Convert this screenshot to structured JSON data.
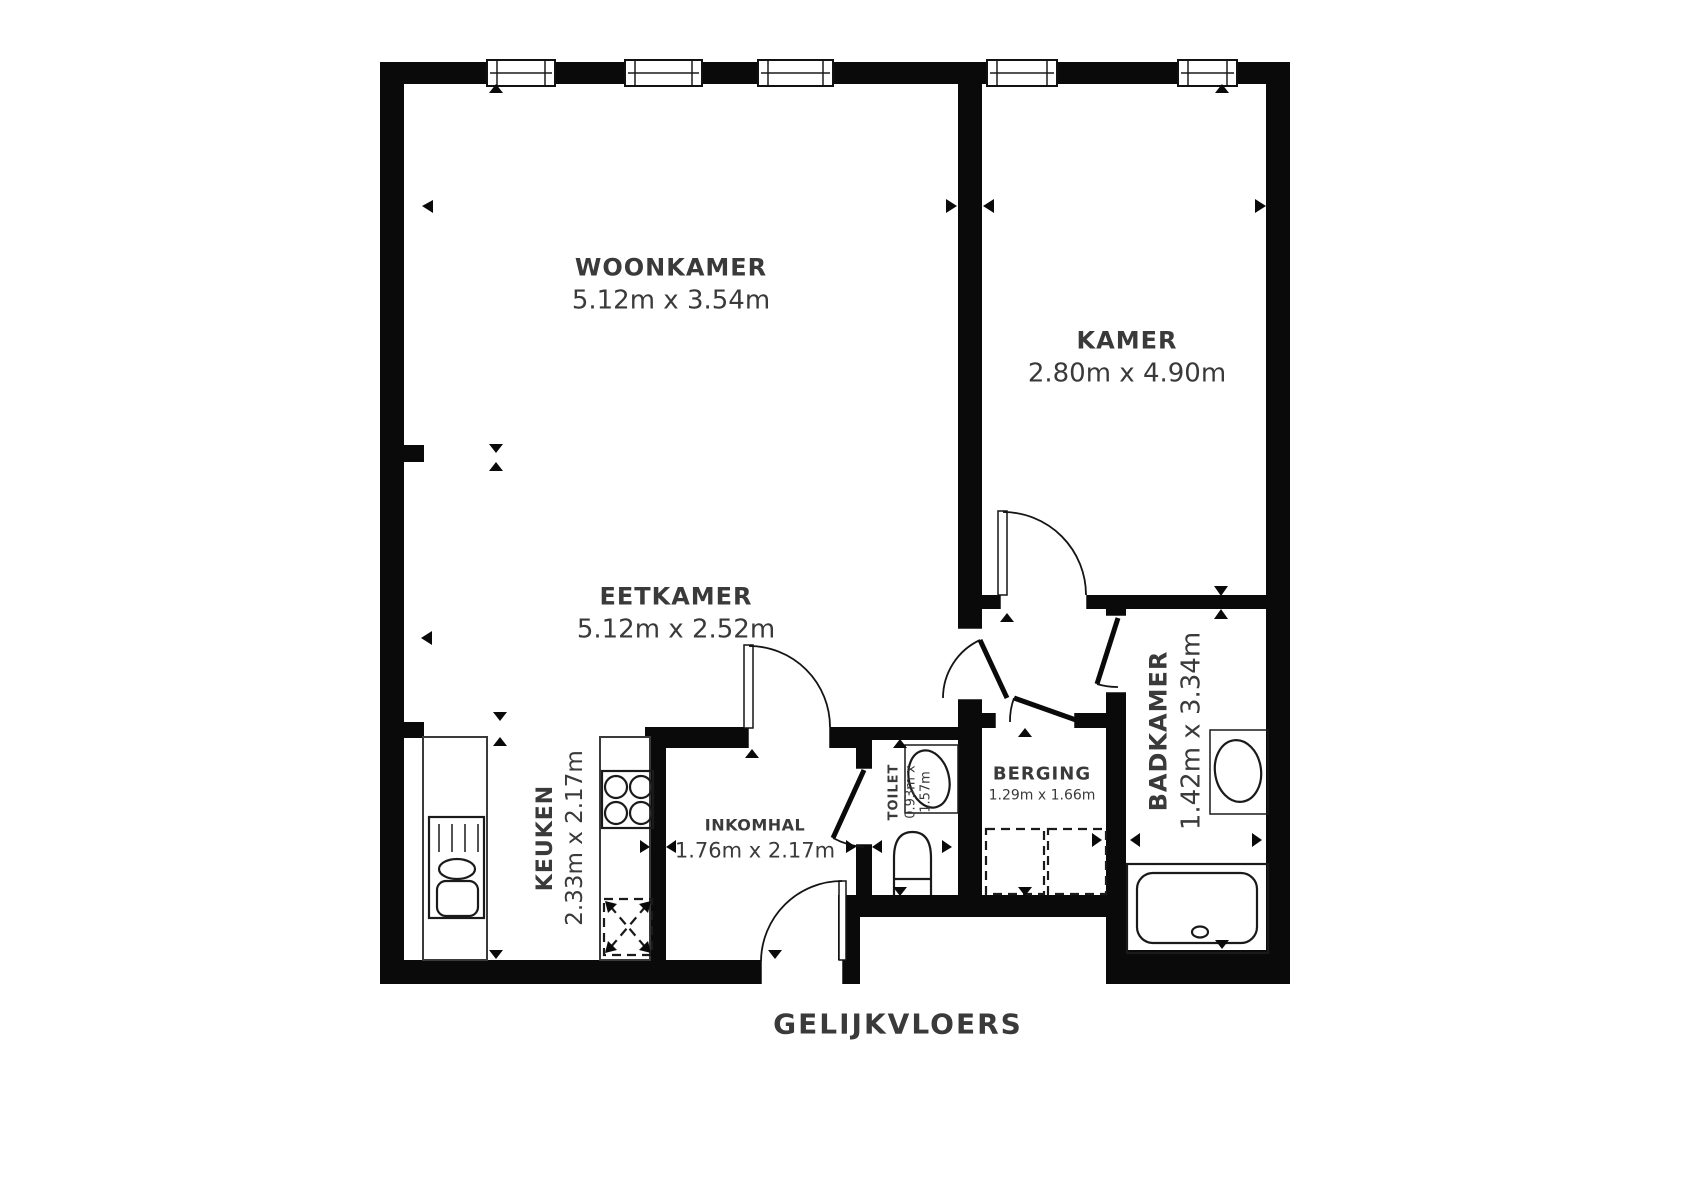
{
  "title": "GELIJKVLOERS",
  "colors": {
    "wall": "#0a0a0a",
    "text": "#3a3a3a",
    "line": "#1a1a1a",
    "background": "#ffffff"
  },
  "rooms": [
    {
      "id": "woonkamer",
      "name": "WOONKAMER",
      "dims": "5.12m x 3.54m"
    },
    {
      "id": "kamer",
      "name": "KAMER",
      "dims": "2.80m x 4.90m"
    },
    {
      "id": "eetkamer",
      "name": "EETKAMER",
      "dims": "5.12m x 2.52m"
    },
    {
      "id": "keuken",
      "name": "KEUKEN",
      "dims": "2.33m x 2.17m"
    },
    {
      "id": "inkomhal",
      "name": "INKOMHAL",
      "dims": "1.76m x 2.17m"
    },
    {
      "id": "toilet",
      "name": "TOILET",
      "dims": "0.93m x 1.57m",
      "dims_lines": [
        "0.93m x",
        "1.57m"
      ]
    },
    {
      "id": "berging",
      "name": "BERGING",
      "dims": "1.29m x 1.66m"
    },
    {
      "id": "badkamer",
      "name": "BADKAMER",
      "dims": "1.42m x 3.34m"
    }
  ],
  "fixtures": [
    "window",
    "door",
    "kitchen-counter",
    "kitchen-sink",
    "stove",
    "dishwasher-space",
    "toilet",
    "hand-basin",
    "washing-machine-space",
    "washbasin",
    "bathtub"
  ]
}
